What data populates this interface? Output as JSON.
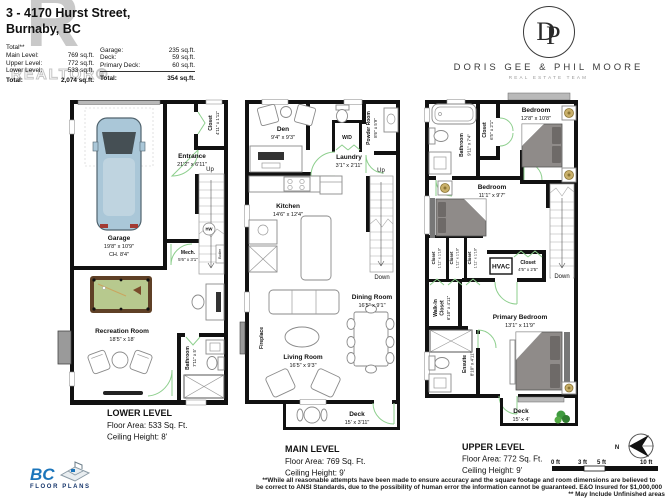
{
  "header": {
    "address_line1": "3 - 4170 Hurst Street,",
    "address_line2": "Burnaby, BC",
    "watermark_letter": "R",
    "watermark_text": "REALTOR®",
    "areas_left": {
      "title": "Total**",
      "rows": [
        {
          "label": "Main Level:",
          "value": "769 sq.ft."
        },
        {
          "label": "Upper Level:",
          "value": "772 sq.ft."
        },
        {
          "label": "Lower Level:",
          "value": "533 sq.ft."
        }
      ],
      "total_label": "Total:",
      "total_value": "2,074 sq.ft."
    },
    "areas_right": {
      "rows": [
        {
          "label": "Garage:",
          "value": "235 sq.ft."
        },
        {
          "label": "Deck:",
          "value": "59 sq.ft."
        },
        {
          "label": "Primary Deck:",
          "value": "60 sq.ft."
        }
      ],
      "total_label": "Total:",
      "total_value": "354 sq.ft."
    }
  },
  "brand": {
    "monogram_d": "D",
    "monogram_p": "P",
    "name": "DORIS GEE & PHIL MOORE",
    "tagline": "REAL ESTATE TEAM"
  },
  "plans": {
    "lower": {
      "rooms": {
        "garage": {
          "name": "Garage",
          "dims": "19'8\" x 10'9\"",
          "extra": "CH. 8'4\""
        },
        "closet": {
          "name": "Closet",
          "dims": "4'11\" x 1'11\""
        },
        "entrance": {
          "name": "Entrance",
          "dims": "21'2\" x 6'11\""
        },
        "stairs_up": "Up",
        "hw": "HW",
        "mech": {
          "name": "Mech.",
          "dims": "5'6\" x 3'1\""
        },
        "boiler": "Boiler",
        "recreation": {
          "name": "Recreation Room",
          "dims": "18'5\" x 18'"
        },
        "bathroom": {
          "name": "Bathroom",
          "dims": "7'11\" x 5'"
        }
      },
      "footer": {
        "title": "LOWER LEVEL",
        "area": "Floor Area: 533 Sq. Ft.",
        "ceiling": "Ceiling Height: 8'"
      }
    },
    "main": {
      "rooms": {
        "den": {
          "name": "Den",
          "dims": "9'4\" x 9'3\""
        },
        "powder": {
          "name": "Powder Room",
          "dims": "8'6\" x 5'9\""
        },
        "wd": "W/D",
        "laundry": {
          "name": "Laundry",
          "dims": "3'1\" x 2'11\""
        },
        "kitchen": {
          "name": "Kitchen",
          "dims": "14'6\" x 12'4\""
        },
        "stairs_up": "Up",
        "stairs_down": "Down",
        "dining": {
          "name": "Dining Room",
          "dims": "16'5\" x 9'1\""
        },
        "living": {
          "name": "Living Room",
          "dims": "16'5\" x 9'3\""
        },
        "fireplace": "Fireplace",
        "deck": {
          "name": "Deck",
          "dims": "15' x 3'11\""
        }
      },
      "footer": {
        "title": "MAIN LEVEL",
        "area": "Floor Area: 769 Sq. Ft.",
        "ceiling": "Ceiling Height: 9'"
      }
    },
    "upper": {
      "rooms": {
        "bathroom": {
          "name": "Bathroom",
          "dims": "9'11\" x 7'4\""
        },
        "closet_hall": {
          "name": "Closet",
          "dims": "6'5\" x 2'1\""
        },
        "bedroom1": {
          "name": "Bedroom",
          "dims": "12'8\" x 10'8\""
        },
        "bedroom2": {
          "name": "Bedroom",
          "dims": "11'1\" x 9'7\""
        },
        "closet_a": {
          "name": "Closet",
          "dims": "1'11\" x 1'10\""
        },
        "closet_b": {
          "name": "Closet",
          "dims": "1'11\" x 1'10\""
        },
        "closet_c": {
          "name": "Closet",
          "dims": "1'11\" x 1'10\""
        },
        "hvac": "HVAC",
        "closet_hvac": {
          "name": "Closet",
          "dims": "4'5\" x 2'5\""
        },
        "walkin": {
          "name1": "Walk-In",
          "name2": "Closet",
          "dims": "6'10\" x 4'11\""
        },
        "primary": {
          "name": "Primary Bedroom",
          "dims": "13'1\" x 11'9\""
        },
        "ensuite": {
          "name": "Ensuite",
          "dims": "8'10\" x 4'11\""
        },
        "stairs_down": "Down",
        "deck": {
          "name": "Deck",
          "dims": "15' x 4'"
        }
      },
      "footer": {
        "title": "UPPER LEVEL",
        "area": "Floor Area: 772 Sq. Ft.",
        "ceiling": "Ceiling Height: 9'"
      }
    }
  },
  "scale_bar": {
    "tick0": "0 ft",
    "tick3": "3 ft",
    "tick5": "5 ft",
    "tick10": "10 ft"
  },
  "compass": {
    "north": "N"
  },
  "disclaimer": {
    "line1": "**While all reasonable attempts have been made to ensure accuracy and the square footage and room dimensions are believed to",
    "line2": "be correct to ANSI Standards, due to the possibility of human error the information cannot be guaranteed. E&O Insured for $1,000,000",
    "line3": "** May Include Unfinished areas"
  },
  "footer_logo": {
    "bc": "BC",
    "floor_plans": "FLOOR PLANS"
  },
  "colors": {
    "wall": "#111111",
    "door_green": "#8ecf8e",
    "brand_blue": "#1b75bb",
    "felt_green": "#b7c98e",
    "car_blue": "#aac7d8"
  }
}
